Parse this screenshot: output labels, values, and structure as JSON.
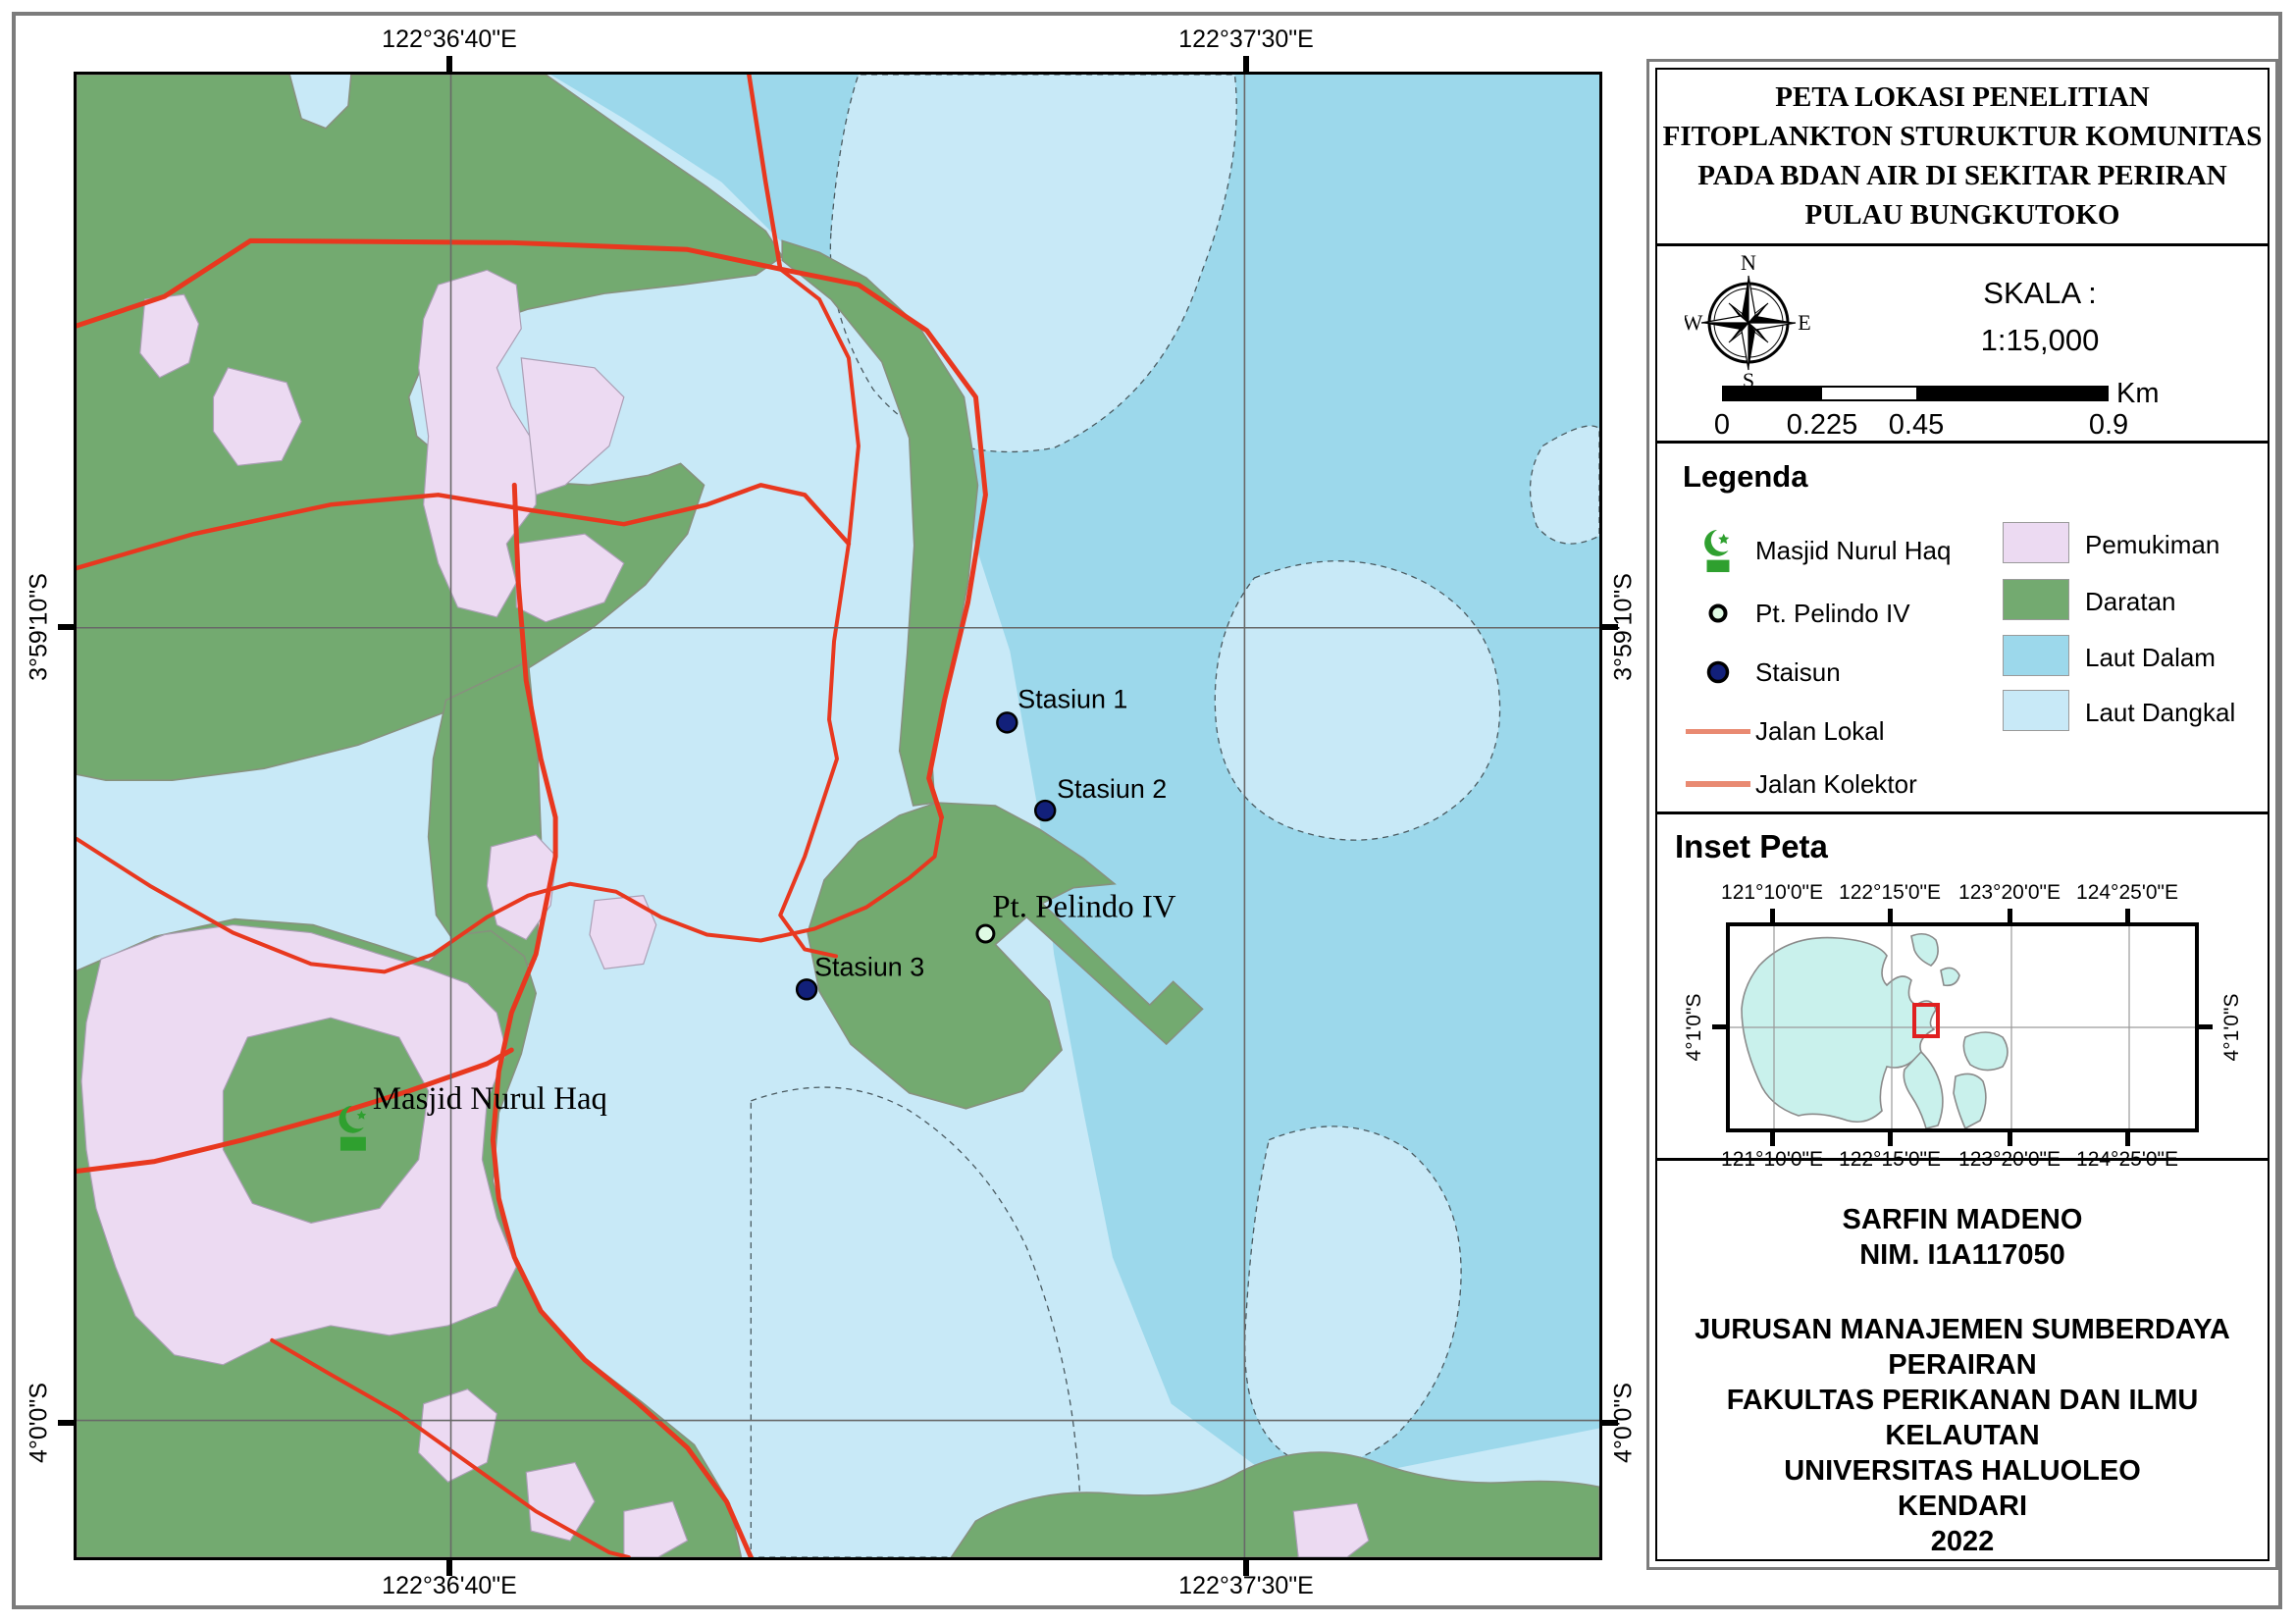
{
  "map": {
    "top_coords": [
      "122°36'40\"E",
      "122°37'30\"E"
    ],
    "bottom_coords": [
      "122°36'40\"E",
      "122°37'30\"E"
    ],
    "left_coords": [
      "3°59'10\"S",
      "4°0'0\"S"
    ],
    "right_coords": [
      "3°59'10\"S",
      "4°0'0\"S"
    ],
    "labels": {
      "stasiun1": "Stasiun 1",
      "stasiun2": "Stasiun 2",
      "stasiun3": "Stasiun 3",
      "pelindo": "Pt. Pelindo IV",
      "masjid": "Masjid Nurul Haq"
    }
  },
  "title_panel": {
    "lines": [
      "PETA LOKASI PENELITIAN",
      "FITOPLANKTON STURUKTUR KOMUNITAS",
      "PADA BDAN AIR DI SEKITAR PERIRAN",
      "PULAU BUNGKUTOKO"
    ]
  },
  "scale_panel": {
    "skala_label": "SKALA :",
    "ratio": "1:15,000",
    "unit": "Km",
    "ticks": [
      "0",
      "0.225",
      "0.45",
      "0.9"
    ],
    "compass": {
      "n": "N",
      "e": "E",
      "s": "S",
      "w": "W"
    }
  },
  "legend": {
    "title": "Legenda",
    "point_items": [
      {
        "label": "Masjid Nurul Haq",
        "icon": "mosque-icon"
      },
      {
        "label": "Pt. Pelindo IV",
        "icon": "pelindo-marker-icon"
      },
      {
        "label": "Staisun",
        "icon": "station-marker-icon"
      },
      {
        "label": "Jalan Lokal",
        "icon": "road-line-icon"
      },
      {
        "label": "Jalan Kolektor",
        "icon": "road-line-thick-icon"
      }
    ],
    "area_items": [
      {
        "label": "Pemukiman",
        "color": "#ECDAF2"
      },
      {
        "label": "Daratan",
        "color": "#73AA70"
      },
      {
        "label": "Laut Dalam",
        "color": "#9CD8EB"
      },
      {
        "label": "Laut Dangkal",
        "color": "#C8E9F7"
      }
    ]
  },
  "inset": {
    "title": "Inset Peta",
    "x_labels_top": [
      "121°10'0\"E",
      "122°15'0\"E",
      "123°20'0\"E",
      "124°25'0\"E"
    ],
    "x_labels_bottom": [
      "121°10'0\"E",
      "122°15'0\"E",
      "123°20'0\"E",
      "124°25'0\"E"
    ],
    "y_label_left": "4°1'0\"S",
    "y_label_right": "4°1'0\"S"
  },
  "credits": {
    "lines": [
      "SARFIN MADENO",
      "NIM. I1A117050",
      "JURUSAN MANAJEMEN SUMBERDAYA PERAIRAN",
      "FAKULTAS PERIKANAN DAN ILMU KELAUTAN",
      "UNIVERSITAS HALUOLEO",
      "KENDARI",
      "2022"
    ]
  },
  "colors": {
    "laut_dangkal": "#C8E9F7",
    "laut_dalam": "#9CD8EB",
    "daratan": "#73AA70",
    "pemukiman": "#ECDAF2",
    "jalan": "#E8381F",
    "jalan_legend": "#E98A72",
    "station_dot": "#12207A",
    "mosque_green": "#2FA02F",
    "inset_land": "#C9F1EC",
    "inset_marker": "#E02020"
  }
}
